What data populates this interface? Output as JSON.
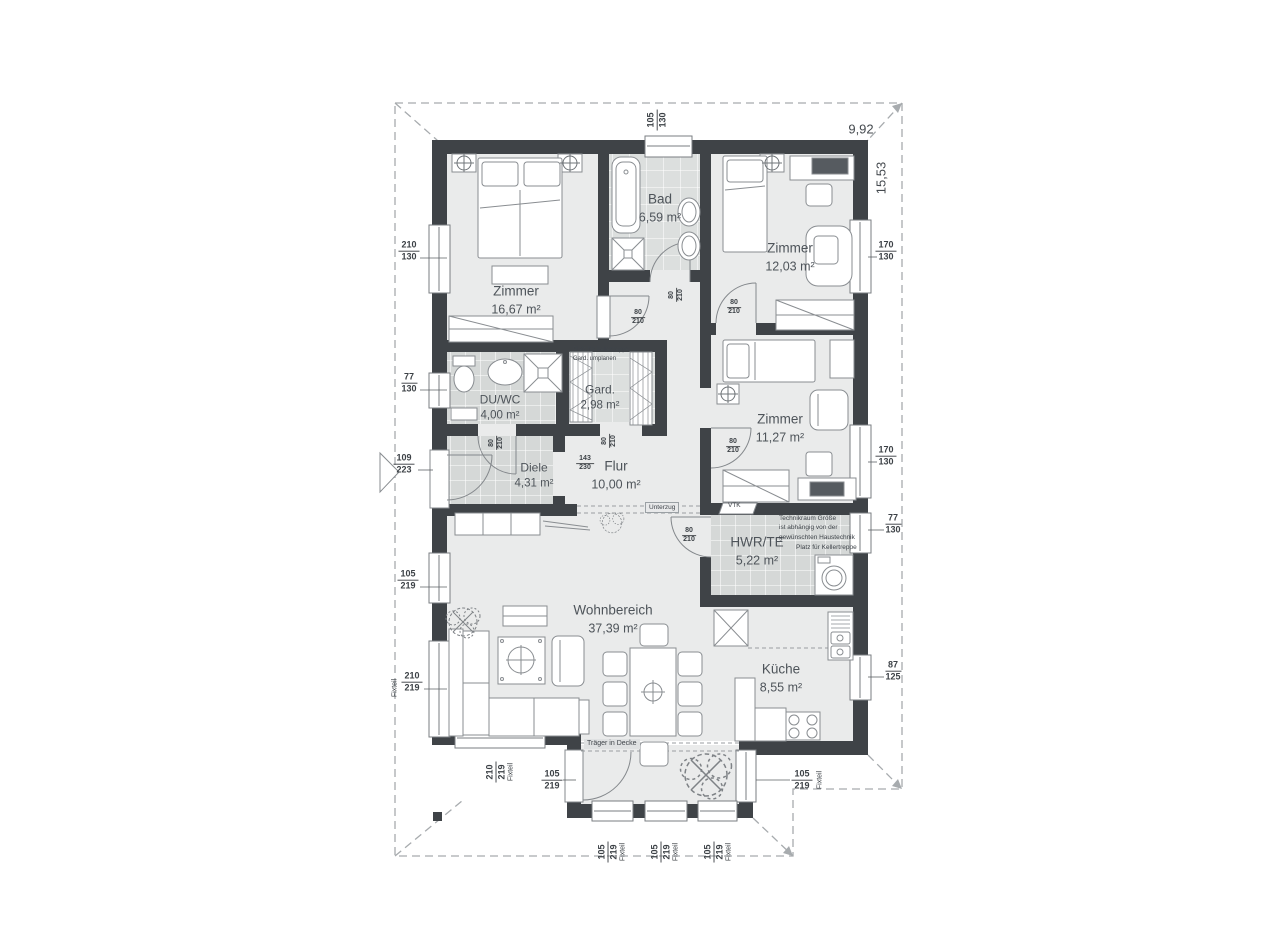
{
  "plan": {
    "overall": {
      "width_label": "9,92",
      "height_label": "15,53"
    },
    "rooms": {
      "zimmer_nw": {
        "name": "Zimmer",
        "area": "16,67 m²"
      },
      "bad": {
        "name": "Bad",
        "area": "6,59 m²"
      },
      "zimmer_ne": {
        "name": "Zimmer",
        "area": "12,03 m²"
      },
      "du_wc": {
        "name": "DU/WC",
        "area": "4,00 m²"
      },
      "gard": {
        "name": "Gard.",
        "area": "2,98 m²"
      },
      "diele": {
        "name": "Diele",
        "area": "4,31 m²"
      },
      "flur": {
        "name": "Flur",
        "area": "10,00 m²"
      },
      "zimmer_e": {
        "name": "Zimmer",
        "area": "11,27 m²"
      },
      "hwr_te": {
        "name": "HWR/TE",
        "area": "5,22 m²"
      },
      "wohnbereich": {
        "name": "Wohnbereich",
        "area": "37,39 m²"
      },
      "kueche": {
        "name": "Küche",
        "area": "8,55 m²"
      }
    },
    "openings": {
      "top_bad": {
        "w": "105",
        "h": "130"
      },
      "left_zimmer_nw": {
        "w": "210",
        "h": "130"
      },
      "left_du_wc": {
        "w": "77",
        "h": "130"
      },
      "entry_door": {
        "w": "109",
        "h": "223"
      },
      "left_wohn": {
        "w": "105",
        "h": "219"
      },
      "left_wohn_fix": {
        "w": "210",
        "h": "219"
      },
      "right_zimmer_ne": {
        "w": "170",
        "h": "130"
      },
      "right_zimmer_e": {
        "w": "170",
        "h": "130"
      },
      "right_hwr": {
        "w": "77",
        "h": "130"
      },
      "right_kueche": {
        "w": "87",
        "h": "125"
      },
      "bottom_wohn_fix": {
        "w": "210",
        "h": "219"
      },
      "bay_door": {
        "w": "105",
        "h": "219"
      },
      "bay_right": {
        "w": "105",
        "h": "219"
      },
      "bay_s1": {
        "w": "105",
        "h": "219"
      },
      "bay_s2": {
        "w": "105",
        "h": "219"
      },
      "bay_s3": {
        "w": "105",
        "h": "219"
      }
    },
    "doors": {
      "zimmer_nw": {
        "w": "80",
        "h": "210"
      },
      "bad": {
        "w": "80",
        "h": "210"
      },
      "zimmer_ne": {
        "w": "80",
        "h": "210"
      },
      "du_wc": {
        "w": "80",
        "h": "210"
      },
      "gard": {
        "w": "80",
        "h": "210"
      },
      "zimmer_e": {
        "w": "80",
        "h": "210"
      },
      "hwr": {
        "w": "80",
        "h": "210"
      },
      "flur_opening": {
        "w": "143",
        "h": "230"
      }
    },
    "notes": {
      "fixteil": "Fixteil",
      "unterzug": "Unterzug",
      "vtk": "VTK",
      "traeger": "Träger in Decke",
      "gard_note": "Platz für Kellertreppe\nGard. umplanen",
      "technik_note": "Technikraum Größe\nist abhängig von der\ngewünschten Haustechnik",
      "keller_note": "Platz für Kellertreppe"
    }
  }
}
